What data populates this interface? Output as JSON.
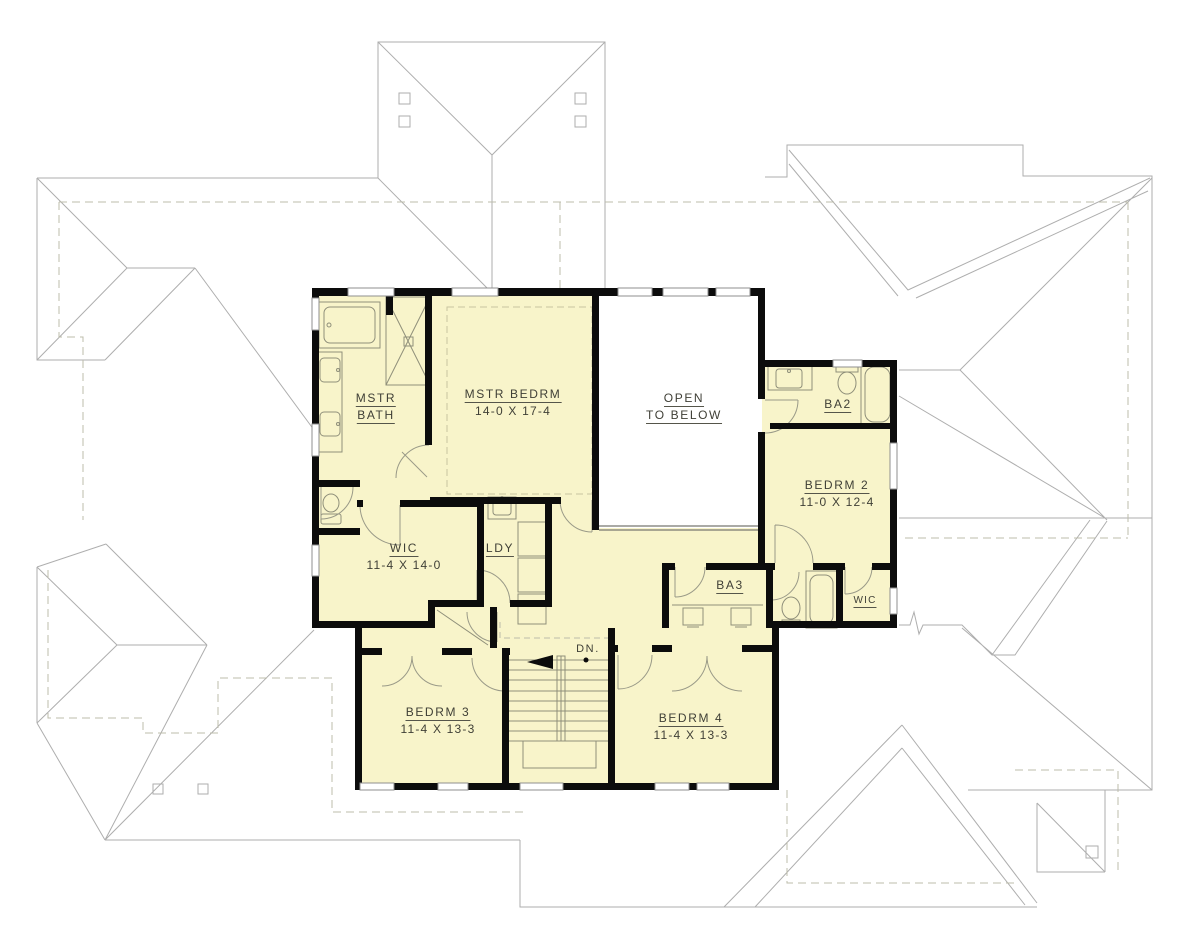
{
  "drawing": {
    "type": "architectural-floor-plan",
    "floor": "upper floor plan with roof outlines"
  },
  "colors": {
    "floor_fill": "#F8F4CA",
    "wall": "#0c0c0c",
    "fixture_line": "#8f8f7a",
    "door_arc": "#9a9a88",
    "roof_line": "#aeaeae",
    "dashed_line": "#bcbcab",
    "railing": "#777770",
    "text": "#3f3f36",
    "background": "#ffffff"
  },
  "rooms": {
    "mstr_bath": {
      "line1": "MSTR",
      "line2": "BATH"
    },
    "mstr_bedrm": {
      "name": "MSTR BEDRM",
      "dims": "14-0 X 17-4"
    },
    "open_below": {
      "line1": "OPEN",
      "line2": "TO BELOW"
    },
    "ba2": {
      "name": "BA2"
    },
    "bedrm2": {
      "name": "BEDRM 2",
      "dims": "11-0 X 12-4"
    },
    "wic": {
      "name": "WIC",
      "dims": "11-4 X 14-0"
    },
    "ldy": {
      "name": "LDY"
    },
    "ba3": {
      "name": "BA3"
    },
    "wic2": {
      "name": "WIC"
    },
    "bedrm3": {
      "name": "BEDRM 3",
      "dims": "11-4 X 13-3"
    },
    "bedrm4": {
      "name": "BEDRM 4",
      "dims": "11-4 X 13-3"
    }
  },
  "stairs": {
    "dn_label": "DN."
  },
  "fixtures": [
    "tub",
    "shower",
    "double-vanity",
    "toilet",
    "laundry-sink",
    "washer-dryer",
    "closet-shelf",
    "stair-run",
    "handrail",
    "railing"
  ]
}
